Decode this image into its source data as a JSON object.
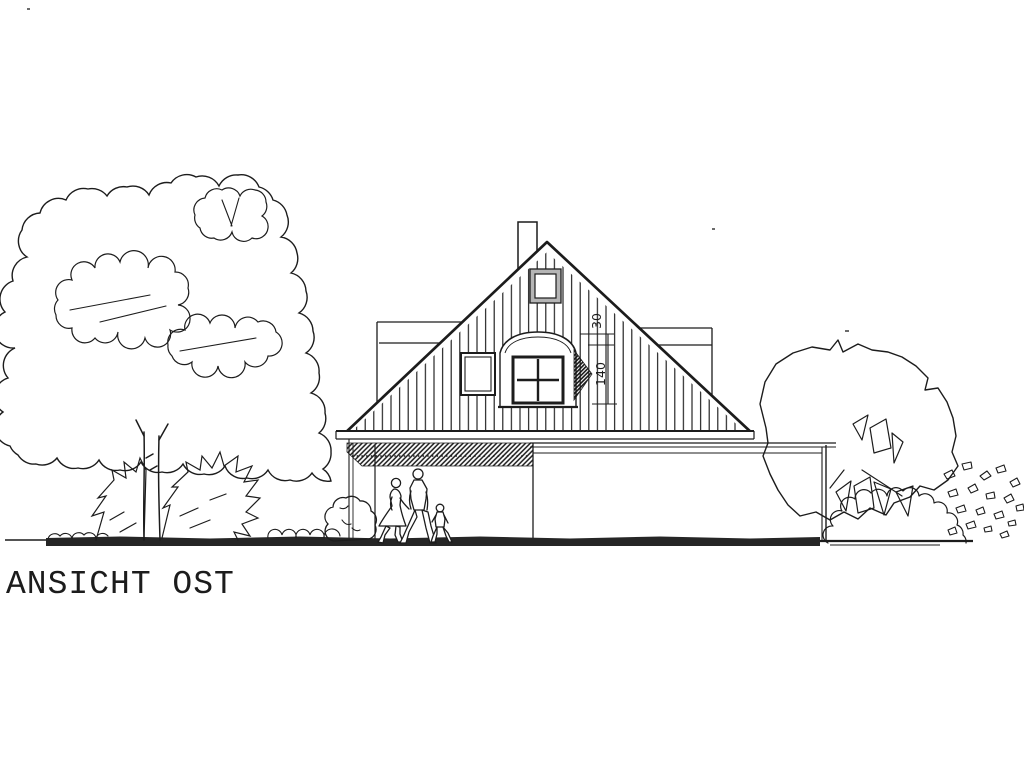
{
  "palette": {
    "paper": "#ffffff",
    "ink": "#1c1c1c",
    "frame_gray": "#b5b5b5",
    "ground_dark": "#262626"
  },
  "title": "ANSICHT OST",
  "annotations": {
    "dim_upper": "30",
    "dim_lower": "140"
  }
}
